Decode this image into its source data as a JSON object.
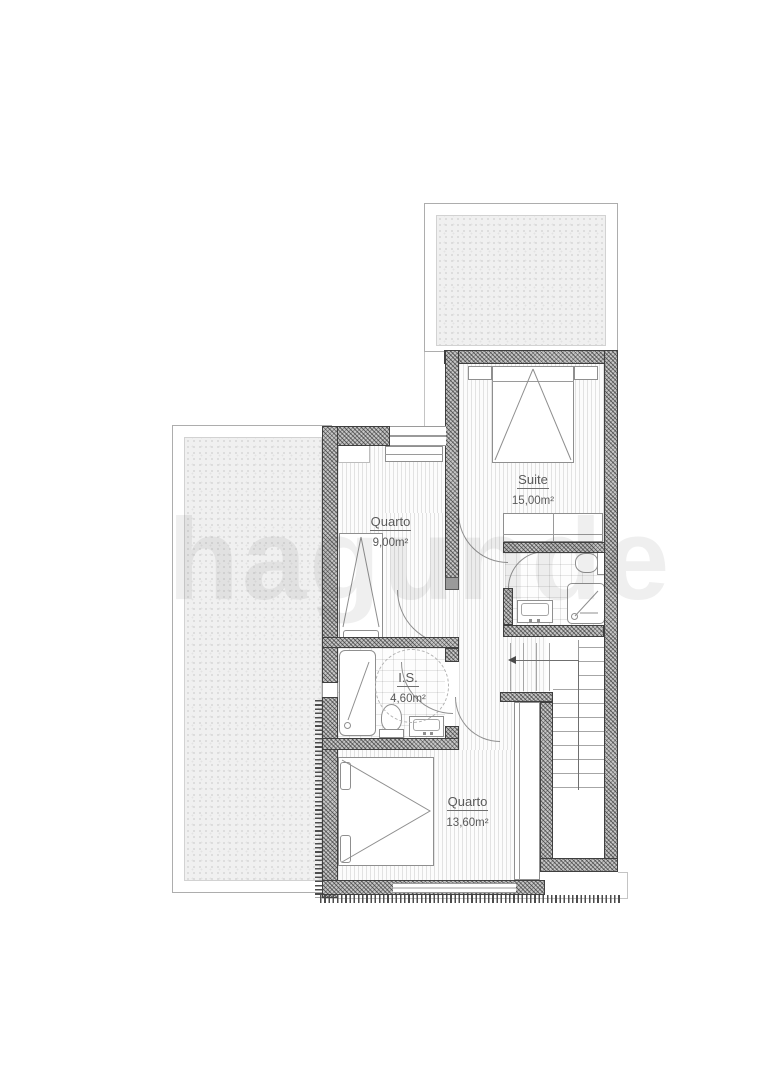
{
  "watermark": {
    "text": "hagunde"
  },
  "rooms": {
    "suite": {
      "name": "Suite",
      "area": "15,00m²"
    },
    "quarto1": {
      "name": "Quarto",
      "area": "9,00m²"
    },
    "is": {
      "name": "I.S.",
      "area": "4,60m²"
    },
    "quarto2": {
      "name": "Quarto",
      "area": "13,60m²"
    }
  },
  "colors": {
    "wall_fill": "#c6c6c6",
    "wall_edge": "#3f3f3f",
    "fixture_stroke": "#8f8f8f",
    "floor_hatch": "rgba(110,110,110,0.18)",
    "terrace_fill": "#f0f0f0",
    "label_text": "#5a5a5a",
    "watermark_text": "rgba(70,70,70,0.085)",
    "background": "#ffffff"
  }
}
